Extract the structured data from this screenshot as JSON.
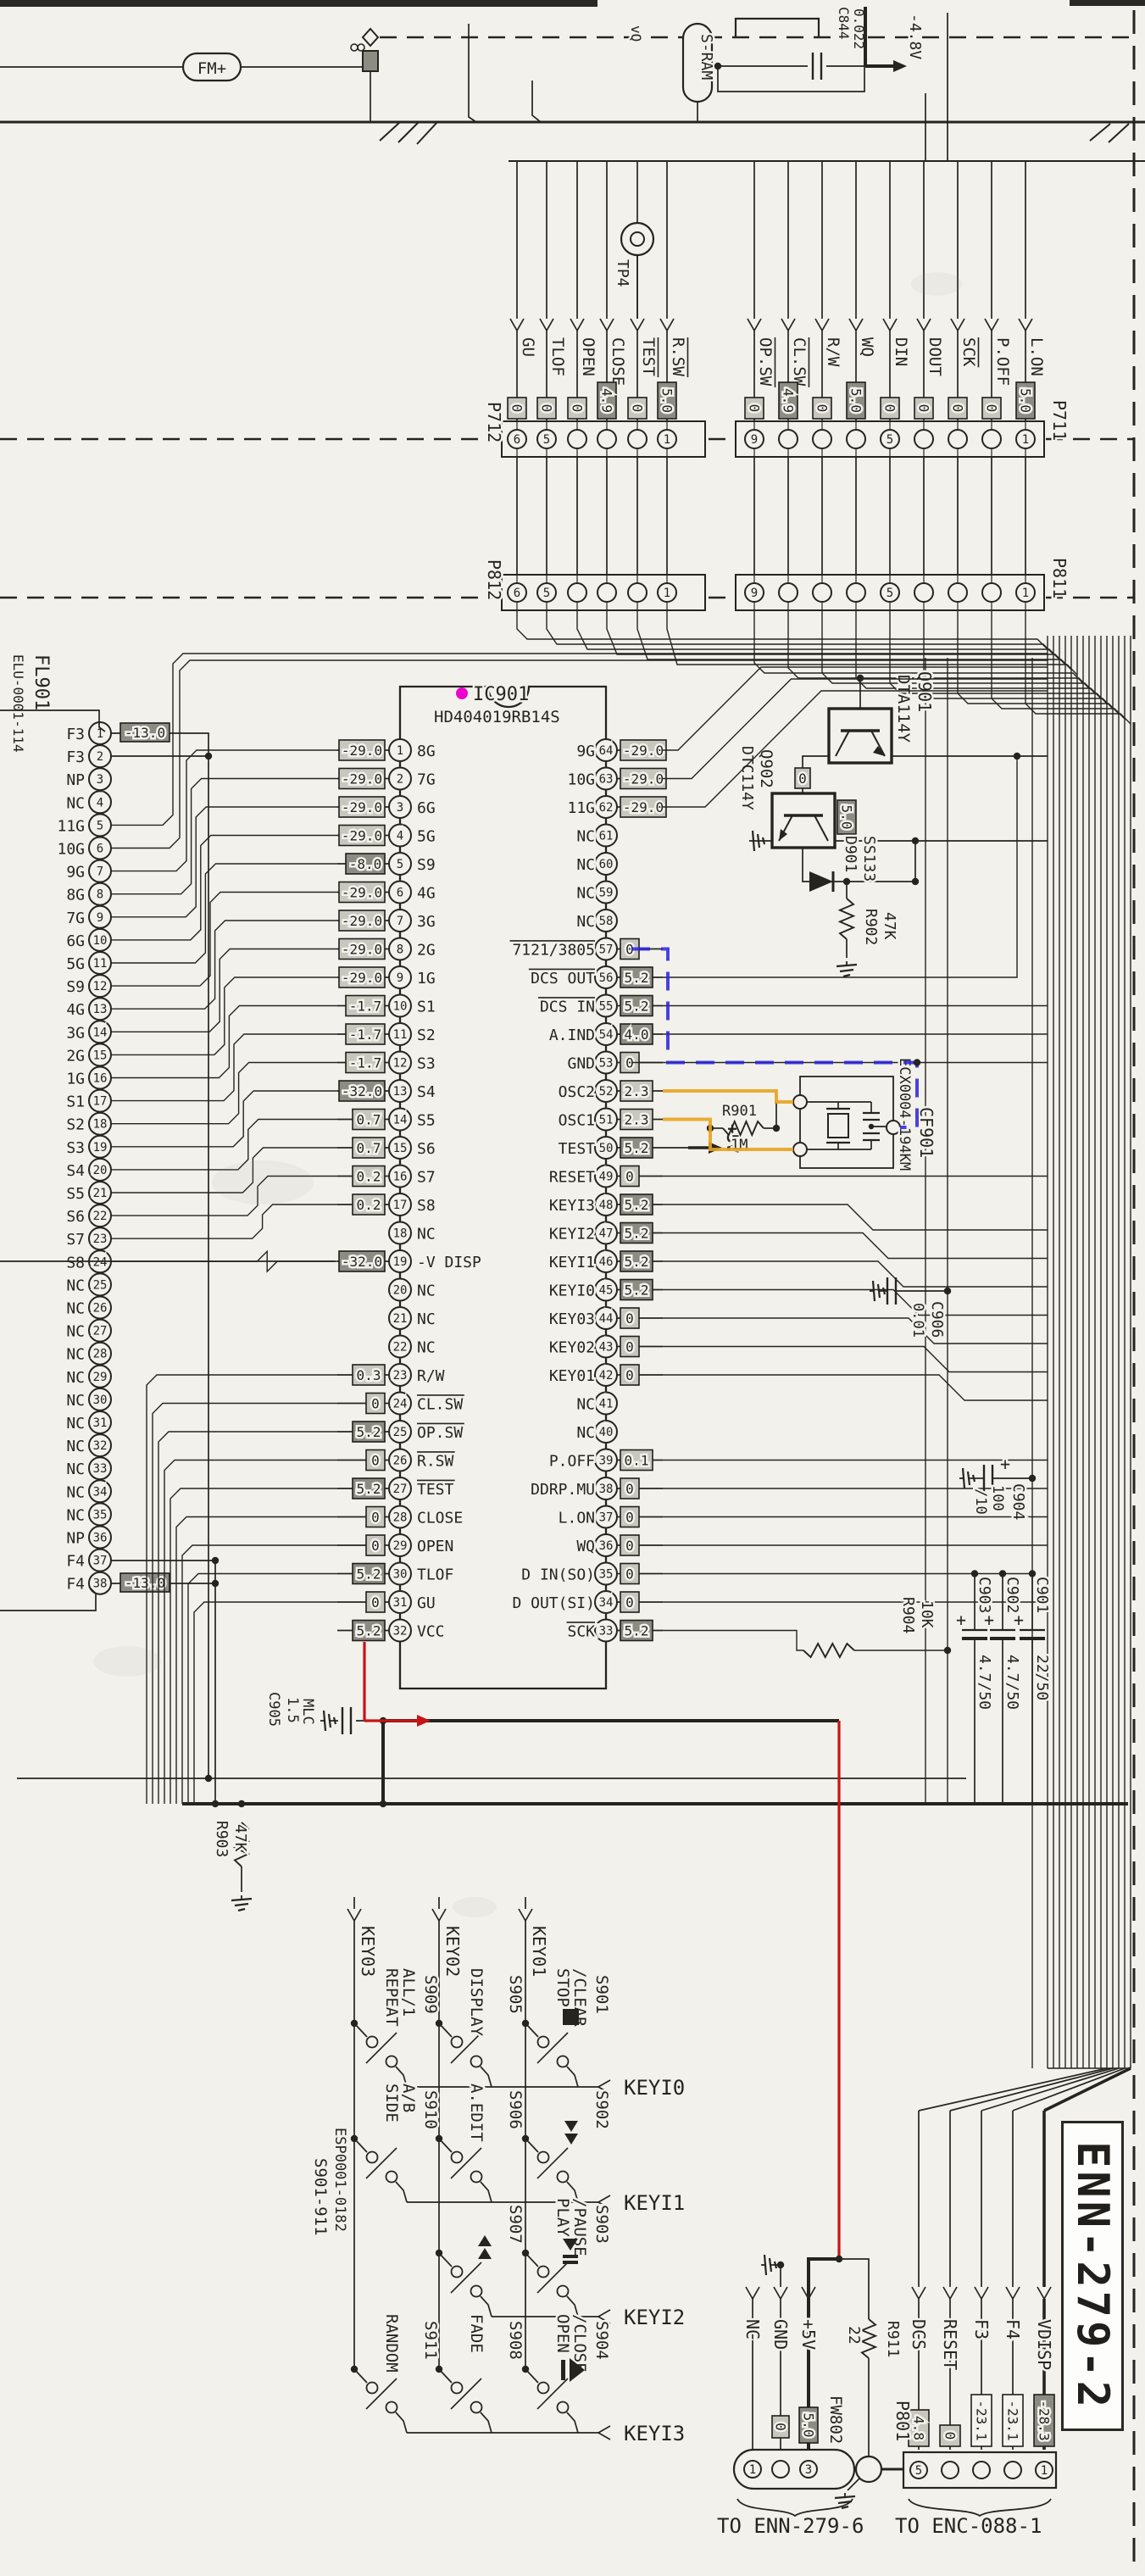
{
  "labels": {
    "title": "ENN-279-2",
    "fm": "FM+",
    "sram": "S-RAM",
    "v48": "-4.8V",
    "vq": "vQ",
    "p5v": "+5V",
    "tp4": "TP4",
    "fl_ref": "FL901",
    "fl_part": "ELU-0001-114"
  },
  "ic901": {
    "ref": "IC901",
    "part": "HD404019RB14S",
    "left_pins": [
      [
        1,
        "8G",
        "-29.0",
        ""
      ],
      [
        2,
        "7G",
        "-29.0",
        ""
      ],
      [
        3,
        "6G",
        "-29.0",
        ""
      ],
      [
        4,
        "5G",
        "-29.0",
        ""
      ],
      [
        5,
        "S9",
        "-8.0",
        "d"
      ],
      [
        6,
        "4G",
        "-29.0",
        ""
      ],
      [
        7,
        "3G",
        "-29.0",
        ""
      ],
      [
        8,
        "2G",
        "-29.0",
        ""
      ],
      [
        9,
        "1G",
        "-29.0",
        ""
      ],
      [
        10,
        "S1",
        "-1.7",
        ""
      ],
      [
        11,
        "S2",
        "-1.7",
        ""
      ],
      [
        12,
        "S3",
        "-1.7",
        ""
      ],
      [
        13,
        "S4",
        "-32.0",
        "d"
      ],
      [
        14,
        "S5",
        "0.7",
        ""
      ],
      [
        15,
        "S6",
        "0.7",
        ""
      ],
      [
        16,
        "S7",
        "0.2",
        ""
      ],
      [
        17,
        "S8",
        "0.2",
        ""
      ],
      [
        18,
        "NC",
        "",
        ""
      ],
      [
        19,
        "-V DISP",
        "-32.0",
        "d"
      ],
      [
        20,
        "NC",
        "",
        ""
      ],
      [
        21,
        "NC",
        "",
        ""
      ],
      [
        22,
        "NC",
        "",
        ""
      ],
      [
        23,
        "R/W",
        "0.3",
        ""
      ],
      [
        24,
        "CL.SW",
        "0",
        "o"
      ],
      [
        25,
        "OP.SW",
        "5.2",
        "od"
      ],
      [
        26,
        "R.SW",
        "0",
        "o"
      ],
      [
        27,
        "TEST",
        "5.2",
        "od"
      ],
      [
        28,
        "CLOSE",
        "0",
        ""
      ],
      [
        29,
        "OPEN",
        "0",
        ""
      ],
      [
        30,
        "TLOF",
        "5.2",
        "d"
      ],
      [
        31,
        "GU",
        "0",
        ""
      ],
      [
        32,
        "VCC",
        "5.2",
        "d"
      ]
    ],
    "right_pins": [
      [
        64,
        "9G",
        "-29.0",
        ""
      ],
      [
        63,
        "10G",
        "-29.0",
        ""
      ],
      [
        62,
        "11G",
        "-29.0",
        ""
      ],
      [
        61,
        "NC",
        "",
        ""
      ],
      [
        60,
        "NC",
        "",
        ""
      ],
      [
        59,
        "NC",
        "",
        ""
      ],
      [
        58,
        "NC",
        "",
        ""
      ],
      [
        57,
        "7121/3805",
        "0",
        "o"
      ],
      [
        56,
        "DCS OUT",
        "5.2",
        "od"
      ],
      [
        55,
        "DCS IN",
        "5.2",
        "od"
      ],
      [
        54,
        "A.IND",
        "4.0",
        "d"
      ],
      [
        53,
        "GND",
        "0",
        ""
      ],
      [
        52,
        "OSC2",
        "2.3",
        ""
      ],
      [
        51,
        "OSC1",
        "2.3",
        ""
      ],
      [
        50,
        "TEST",
        "5.2",
        "d"
      ],
      [
        49,
        "RESET",
        "0",
        ""
      ],
      [
        48,
        "KEYI3",
        "5.2",
        "d"
      ],
      [
        47,
        "KEYI2",
        "5.2",
        "d"
      ],
      [
        46,
        "KEYI1",
        "5.2",
        "d"
      ],
      [
        45,
        "KEYI0",
        "5.2",
        "d"
      ],
      [
        44,
        "KEY03",
        "0",
        ""
      ],
      [
        43,
        "KEY02",
        "0",
        ""
      ],
      [
        42,
        "KEY01",
        "0",
        ""
      ],
      [
        41,
        "NC",
        "",
        ""
      ],
      [
        40,
        "NC",
        "",
        ""
      ],
      [
        39,
        "P.OFF",
        "0.1",
        ""
      ],
      [
        38,
        "DDRP.MU",
        "0",
        ""
      ],
      [
        37,
        "L.ON",
        "0",
        ""
      ],
      [
        36,
        "WQ",
        "0",
        ""
      ],
      [
        35,
        "D IN(SO)",
        "0",
        ""
      ],
      [
        34,
        "D OUT(SI)",
        "0",
        ""
      ],
      [
        33,
        "SCK",
        "5.2",
        "od"
      ]
    ]
  },
  "fl901": {
    "pins": [
      [
        1,
        "F3",
        "-13.0"
      ],
      [
        2,
        "F3",
        ""
      ],
      [
        3,
        "NP",
        ""
      ],
      [
        4,
        "NC",
        ""
      ],
      [
        5,
        "11G",
        ""
      ],
      [
        6,
        "10G",
        ""
      ],
      [
        7,
        "9G",
        ""
      ],
      [
        8,
        "8G",
        ""
      ],
      [
        9,
        "7G",
        ""
      ],
      [
        10,
        "6G",
        ""
      ],
      [
        11,
        "5G",
        ""
      ],
      [
        12,
        "S9",
        ""
      ],
      [
        13,
        "4G",
        ""
      ],
      [
        14,
        "3G",
        ""
      ],
      [
        15,
        "2G",
        ""
      ],
      [
        16,
        "1G",
        ""
      ],
      [
        17,
        "S1",
        ""
      ],
      [
        18,
        "S2",
        ""
      ],
      [
        19,
        "S3",
        ""
      ],
      [
        20,
        "S4",
        ""
      ],
      [
        21,
        "S5",
        ""
      ],
      [
        22,
        "S6",
        ""
      ],
      [
        23,
        "S7",
        ""
      ],
      [
        24,
        "S8",
        ""
      ],
      [
        25,
        "NC",
        ""
      ],
      [
        26,
        "NC",
        ""
      ],
      [
        27,
        "NC",
        ""
      ],
      [
        28,
        "NC",
        ""
      ],
      [
        29,
        "NC",
        ""
      ],
      [
        30,
        "NC",
        ""
      ],
      [
        31,
        "NC",
        ""
      ],
      [
        32,
        "NC",
        ""
      ],
      [
        33,
        "NC",
        ""
      ],
      [
        34,
        "NC",
        ""
      ],
      [
        35,
        "NC",
        ""
      ],
      [
        36,
        "NP",
        ""
      ],
      [
        37,
        "F4",
        ""
      ],
      [
        38,
        "F4",
        "-13.0"
      ]
    ]
  },
  "connectors": {
    "p712": {
      "label": "P712",
      "nums": [
        6,
        5,
        1
      ],
      "signals": [
        [
          6,
          "GU",
          "0",
          ""
        ],
        [
          5,
          "TLOF",
          "0",
          ""
        ],
        [
          4,
          "OPEN",
          "0",
          ""
        ],
        [
          3,
          "CLOSE",
          "4.9",
          "d"
        ],
        [
          2,
          "TEST",
          "0",
          "o"
        ],
        [
          1,
          "R.SW",
          "5.0",
          "od"
        ]
      ]
    },
    "p711": {
      "label": "P711",
      "nums": [
        9,
        5,
        1
      ],
      "signals": [
        [
          9,
          "OP.SW",
          "0",
          "o"
        ],
        [
          8,
          "CL.SW",
          "4.9",
          "od"
        ],
        [
          7,
          "R/W",
          "0",
          ""
        ],
        [
          6,
          "WQ",
          "5.0",
          "d"
        ],
        [
          5,
          "DIN",
          "0",
          ""
        ],
        [
          4,
          "DOUT",
          "0",
          ""
        ],
        [
          3,
          "SCK",
          "0",
          "o"
        ],
        [
          2,
          "P.OFF",
          "0",
          ""
        ],
        [
          1,
          "L.ON",
          "5.0",
          "d"
        ]
      ]
    },
    "p812": {
      "label": "P812",
      "nums": [
        6,
        5,
        1
      ]
    },
    "p811": {
      "label": "P811",
      "nums": [
        9,
        5,
        1
      ]
    },
    "p801": {
      "label": "P801",
      "nums": [
        5,
        1
      ],
      "caption": "TO ENC-088-1",
      "signals": [
        [
          5,
          "DCS",
          "4.8",
          ""
        ],
        [
          4,
          "RESET",
          "0",
          ""
        ],
        [
          3,
          "F3",
          "-23.1",
          "w"
        ],
        [
          2,
          "F4",
          "-23.1",
          "w"
        ],
        [
          1,
          "VDISP",
          "-28.3",
          "d"
        ]
      ]
    },
    "enn": {
      "caption": "TO ENN-279-6",
      "signals": [
        [
          1,
          "NC",
          "",
          ""
        ],
        [
          2,
          "GND",
          "0",
          ""
        ],
        [
          3,
          "+5V",
          "",
          ""
        ]
      ],
      "fw_ref": "FW802",
      "fw_v": "5.0",
      "r_ref": "R911",
      "r_val": "22"
    }
  },
  "components": {
    "c844": [
      "C844",
      "0.022"
    ],
    "c901": [
      "C901",
      "22/50"
    ],
    "c902": [
      "C902",
      "4.7/50"
    ],
    "c903": [
      "C903",
      "4.7/50"
    ],
    "c904": [
      "C904",
      "100",
      "/10"
    ],
    "c905": [
      "C905",
      "1.5",
      "MLC"
    ],
    "c906": [
      "C906",
      "0.01"
    ],
    "r901": [
      "R901",
      "1M"
    ],
    "r902": [
      "R902",
      "47K"
    ],
    "r903": [
      "R903",
      "47K"
    ],
    "r904": [
      "R904",
      "10K"
    ],
    "d901": [
      "D901",
      "SS133"
    ],
    "cf901": [
      "CF901",
      "ECX0004-194KM"
    ],
    "q901": [
      "Q901",
      "DTA114Y"
    ],
    "q902": [
      "Q902",
      "DTC114Y"
    ]
  },
  "key_matrix": {
    "cols": [
      "KEY03",
      "KEY02",
      "KEY01"
    ],
    "rows": [
      "KEYI0",
      "KEYI1",
      "KEYI2",
      "KEYI3"
    ],
    "group": [
      "S901-911",
      "ESP0001-0182"
    ],
    "switches": [
      {
        "ref": "S909",
        "fn": [
          "REPEAT",
          "ALL/1"
        ],
        "c": 0,
        "r": 0,
        "icon": ""
      },
      {
        "ref": "S905",
        "fn": [
          "DISPLAY"
        ],
        "c": 1,
        "r": 0,
        "icon": ""
      },
      {
        "ref": "S901",
        "fn": [
          "STOP",
          "/CLEAR"
        ],
        "c": 2,
        "r": 0,
        "icon": "stop"
      },
      {
        "ref": "S910",
        "fn": [
          "SIDE",
          "A/B"
        ],
        "c": 0,
        "r": 1,
        "icon": ""
      },
      {
        "ref": "S906",
        "fn": [
          "A.EDIT"
        ],
        "c": 1,
        "r": 1,
        "icon": ""
      },
      {
        "ref": "S902",
        "fn": [],
        "c": 2,
        "r": 1,
        "icon": "ff"
      },
      {
        "ref": "S907",
        "fn": [],
        "c": 1,
        "r": 2,
        "icon": "rew"
      },
      {
        "ref": "S903",
        "fn": [
          "PLAY",
          "/PAUSE"
        ],
        "c": 2,
        "r": 2,
        "icon": "playpause"
      },
      {
        "ref": "S911",
        "fn": [
          "RANDOM"
        ],
        "c": 0,
        "r": 3,
        "icon": ""
      },
      {
        "ref": "S908",
        "fn": [
          "FADE"
        ],
        "c": 1,
        "r": 3,
        "icon": ""
      },
      {
        "ref": "S904",
        "fn": [
          "OPEN",
          "/CLOSE"
        ],
        "c": 2,
        "r": 3,
        "icon": "eject"
      }
    ]
  }
}
